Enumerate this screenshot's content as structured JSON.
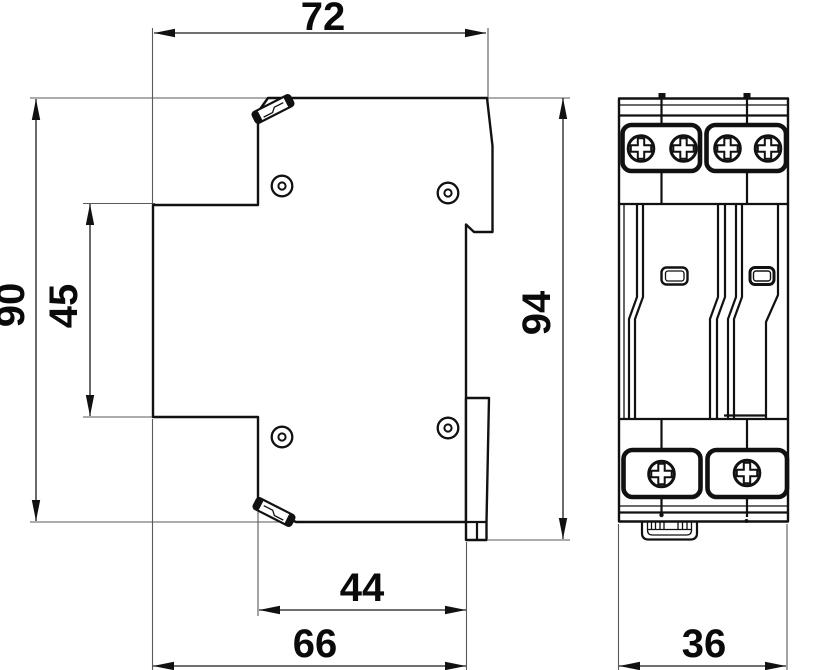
{
  "drawing": {
    "type": "technical-dimension-drawing",
    "views": {
      "side_view_dimensions": {
        "top_width": "72",
        "overall_height": "90",
        "front_step_height": "45",
        "rear_overall_height": "94",
        "bottom_step_width": "44",
        "bottom_overall_width": "66"
      },
      "front_view_dimensions": {
        "overall_width": "36"
      }
    },
    "colors": {
      "background": "#ffffff",
      "outline": "#111111",
      "extension_line": "#5a5a5a",
      "text": "#0a0a0a"
    }
  }
}
